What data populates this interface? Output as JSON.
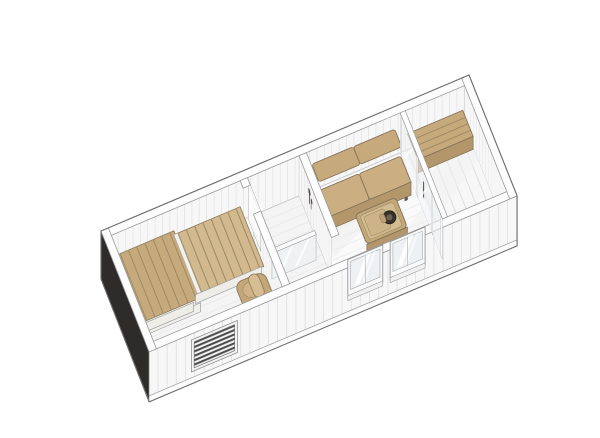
{
  "meta": {
    "description": "3D axonometric cutaway floor plan of a small sauna cabin, viewed from above at an angle, walls sectioned horizontally",
    "background": "#ffffff"
  },
  "colors": {
    "wall_top": "#fdfdfd",
    "wall_face": "#f7f7f8",
    "panel_line": "#dcdcde",
    "outline": "#6e6e6e",
    "edge_line": "#9b9b9b",
    "dark_end_wall": "#2e2c2a",
    "floor": "#f4f4f5",
    "floor_living": "#fafafb",
    "deck": "#f7f7f8",
    "wood": "#c7aa7b",
    "wood_light": "#d2ba8e",
    "wood_dark": "#b3976b",
    "wood_gap": "#9d8a66",
    "bench_edge": "#f3f1ec",
    "glass": "#eef1f3",
    "vent_dark": "#4c4c4c",
    "fixture": "#4a4139",
    "burner": "#38322a"
  },
  "rooms": [
    {
      "id": "sauna",
      "name": "Sauna room",
      "furniture": [
        "tiered wooden bench platform",
        "sauna heater",
        "ventilation grille in front wall",
        "open door to shower room"
      ]
    },
    {
      "id": "shower",
      "name": "Shower room",
      "furniture": [
        "wall-mounted shower mixer",
        "half-height glass screen"
      ]
    },
    {
      "id": "lounge",
      "name": "Lounge room",
      "furniture": [
        "two-seat wooden sofa",
        "stove table with round burner",
        "two front windows"
      ]
    },
    {
      "id": "terrace",
      "name": "Terrace",
      "furniture": [
        "back wall bench",
        "front parapet bench",
        "glazed wall with door",
        "diagonal decking"
      ]
    }
  ]
}
